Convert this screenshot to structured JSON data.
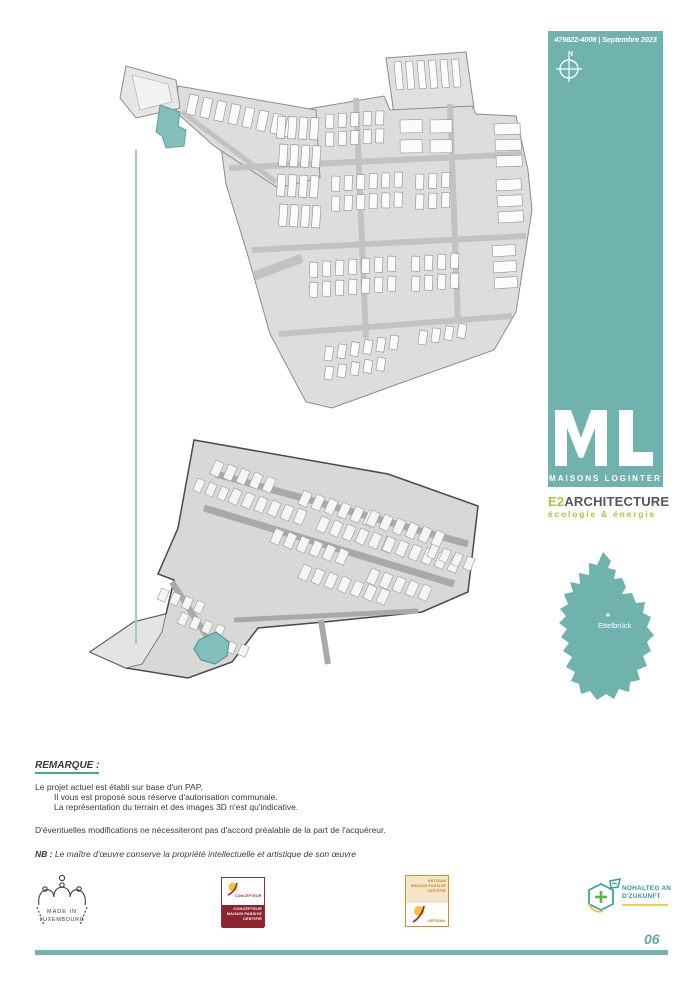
{
  "header": {
    "ref_date": "479822-4008 | Septembre 2023",
    "compass_label": "N"
  },
  "brand": {
    "name": "MAISONS  LOGINTER"
  },
  "studio": {
    "prefix": "E2",
    "name": "ARCHITECTURE",
    "tagline": "écologie & énergie"
  },
  "map": {
    "city": "Ettelbrück"
  },
  "remarks": {
    "title": "REMARQUE :",
    "line1": "Le projet actuel est établi sur base d'un PAP.",
    "line2": "Il vous est proposé sous réserve d'autorisation communale.",
    "line3": "La représentation du terrain et des images  3D n'est qu'indicative.",
    "line4": "D'éventuelles modifications ne nécessiteront pas d'accord préalable de la part de l'acquéreur.",
    "nb_label": "NB :",
    "nb_text": " Le maître d'œuvre conserve la propriété intellectuelle et artistique de son œuvre"
  },
  "certifications": {
    "made_in": {
      "line1": "MADE IN",
      "line2": "LUXEMBOURG"
    },
    "concepteur": {
      "label": "CONCEPTEUR",
      "band_line1": "CONCEPTEUR",
      "band_line2": "MAISON PASSIVE",
      "band_line3": "CERTIFIÉ"
    },
    "artisan": {
      "band_line1": "ARTISAN",
      "band_line2": "MAISON PASSIVE",
      "band_line3": "CERTIFIÉ",
      "label": "ARTISAN"
    },
    "nohalteg": {
      "line1": "NOHALTEG AN",
      "line2": "D'ZUKUNFT"
    }
  },
  "footer": {
    "page_number": "06"
  }
}
